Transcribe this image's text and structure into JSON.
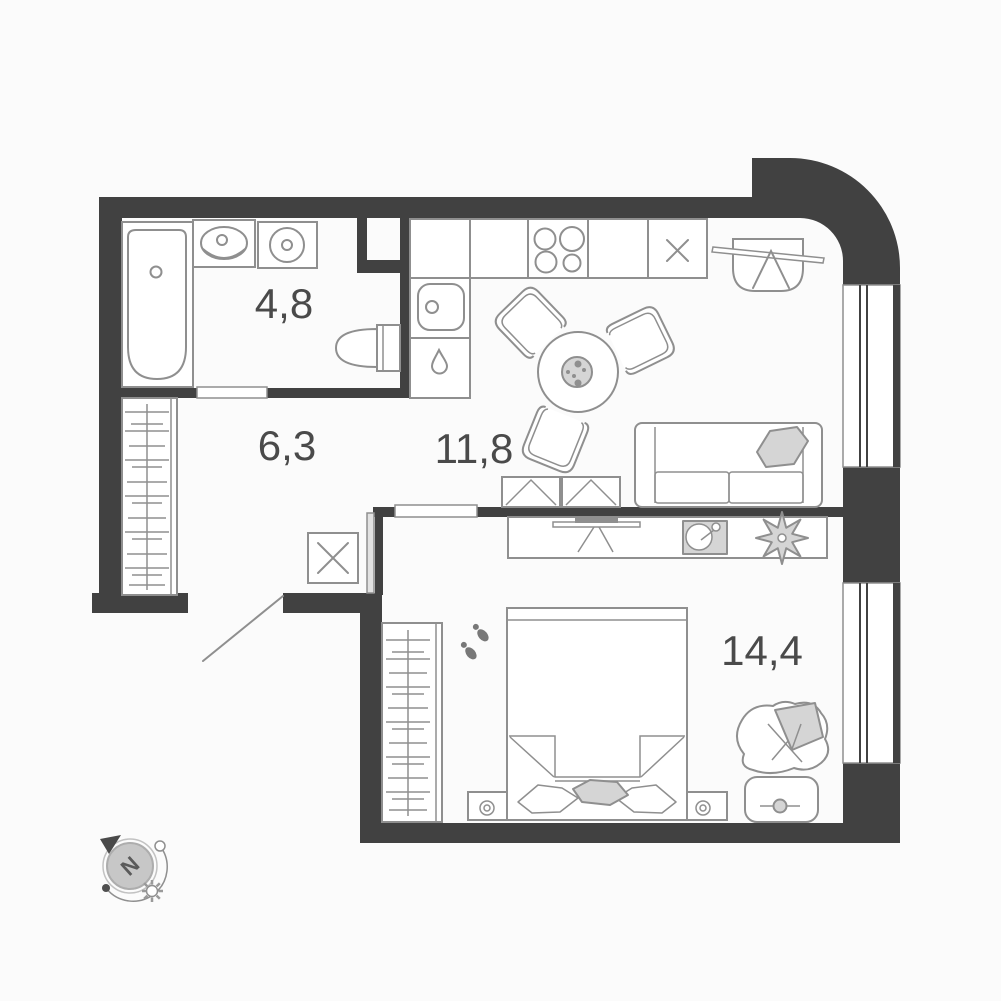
{
  "colors": {
    "wall": "#414141",
    "outline": "#8f8f8f",
    "outline_dark": "#787878",
    "fill_light": "#d5d5d5",
    "background": "#fbfbfb",
    "label": "#4a4a4a"
  },
  "rooms": [
    {
      "id": "bathroom",
      "area_label": "4,8"
    },
    {
      "id": "hallway",
      "area_label": "6,3"
    },
    {
      "id": "kitchen_living",
      "area_label": "11,8"
    },
    {
      "id": "bedroom",
      "area_label": "14,4"
    }
  ],
  "compass": {
    "north_label": "N"
  }
}
